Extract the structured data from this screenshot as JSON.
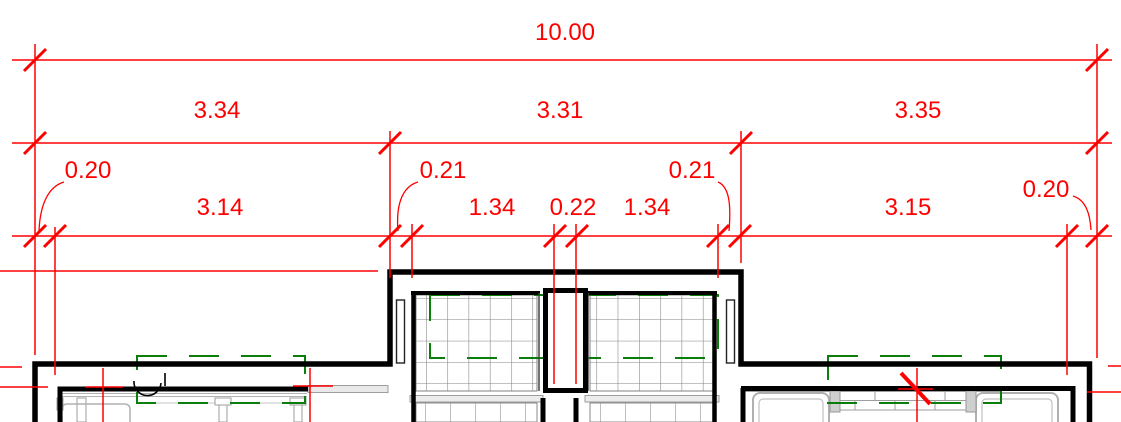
{
  "colors": {
    "dimension_red": "#ff0000",
    "wall_black": "#000000",
    "tile_grid_gray": "#808080",
    "detail_light_gray": "#b3b3b3",
    "dashed_green": "#0a7d0a"
  },
  "dimensions": {
    "total": {
      "label": "10.00"
    },
    "bay_spans": [
      {
        "label": "3.34"
      },
      {
        "label": "3.31"
      },
      {
        "label": "3.35"
      }
    ],
    "wall_offsets": [
      {
        "label": "0.20"
      },
      {
        "label": "0.21"
      },
      {
        "label": "0.21"
      },
      {
        "label": "0.20"
      }
    ],
    "openings": [
      {
        "label": "3.14"
      },
      {
        "label": "1.34"
      },
      {
        "label": "0.22"
      },
      {
        "label": "1.34"
      },
      {
        "label": "3.15"
      }
    ]
  }
}
